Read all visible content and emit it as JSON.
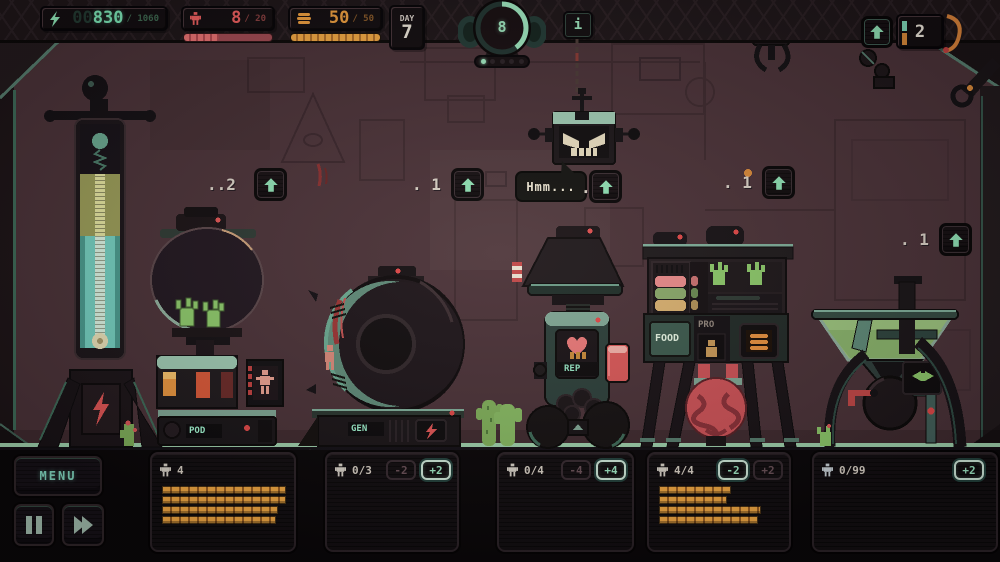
{
  "colors": {
    "accent_mint": "#9fe3c0",
    "accent_orange": "#eda23f",
    "accent_red": "#e85a55",
    "wall": "#4a3238",
    "bar_orange": "#f0a043"
  },
  "hud": {
    "energy": {
      "ghost": "00",
      "value": "830",
      "max": "/ 1060"
    },
    "population": {
      "value": "8",
      "max": "/ 20",
      "fill_pct": 40
    },
    "food": {
      "value": "50",
      "max": "/ 50",
      "fill_pct": 100
    },
    "day": {
      "label": "DAY",
      "value": "7"
    },
    "gauge": {
      "value": "8",
      "dots_total": 5,
      "dots_lit": 1,
      "pct": 40
    },
    "info_label": "i",
    "capacity": {
      "value": "2"
    }
  },
  "upgrades": {
    "pod_cost": "..2",
    "gen_cost": ". 1",
    "rep_cost": ".",
    "food_cost": ". 1",
    "grinder_cost": ". 1"
  },
  "robot": {
    "speech": "Hmm..."
  },
  "machines": {
    "pod_label": "POD",
    "gen_label": "GEN",
    "rep_label": "REP",
    "food_label": "FOOD",
    "pro_label": "PRO"
  },
  "bottom": {
    "menu_label": "MENU",
    "slots": [
      {
        "count": "4",
        "bars": [
          122,
          122,
          114,
          112
        ]
      },
      {
        "count": "0/3",
        "minus": "-2",
        "plus": "+2"
      },
      {
        "count": "0/4",
        "minus": "-4",
        "plus": "+4"
      },
      {
        "count": "4/4",
        "minus": "-2",
        "plus": "+2",
        "bars": [
          70,
          66,
          100,
          97
        ]
      },
      {
        "count": "0/99",
        "plus": "+2"
      }
    ]
  }
}
